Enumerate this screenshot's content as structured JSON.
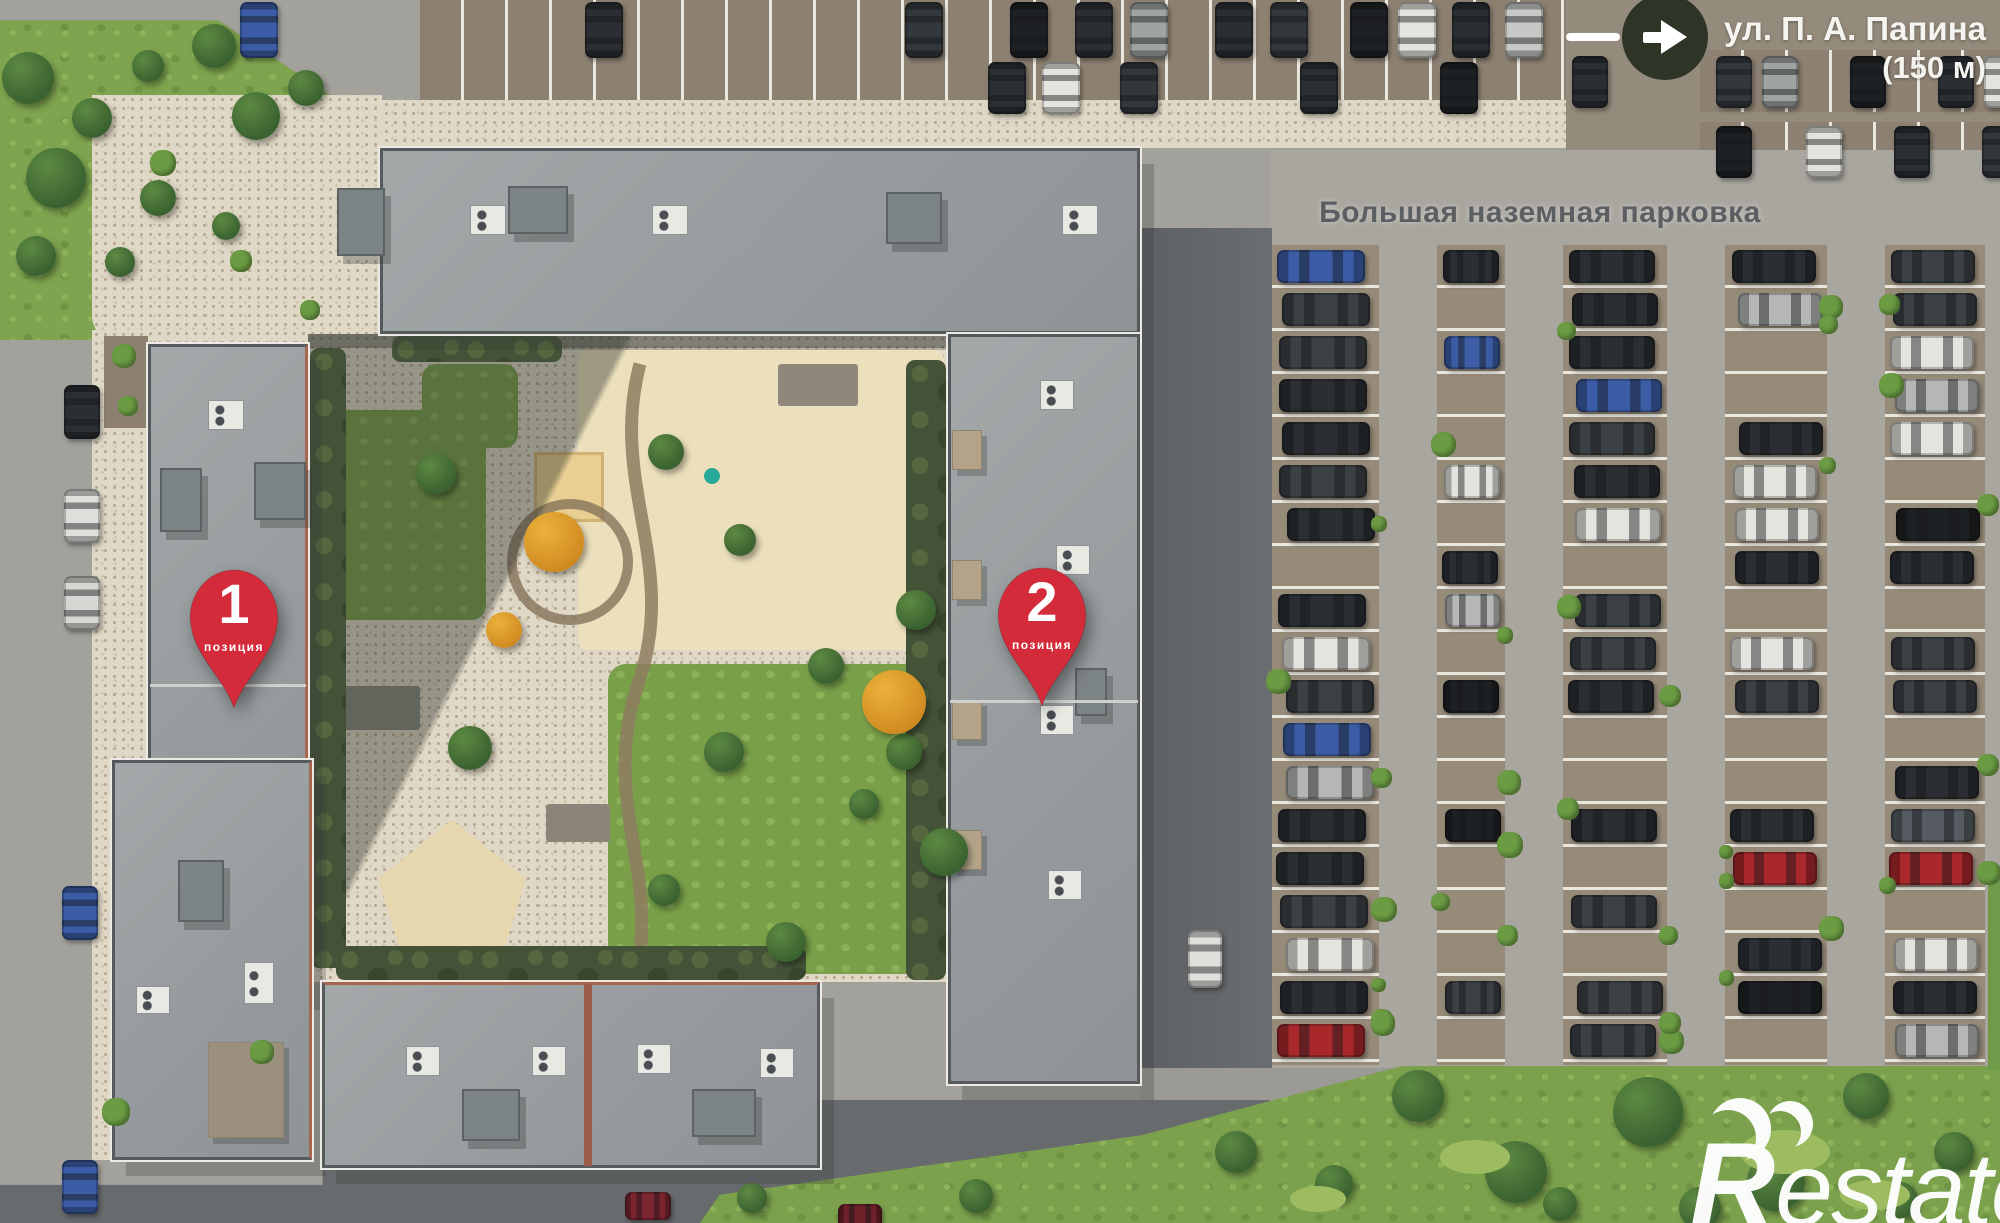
{
  "street_sign": {
    "name_line": "ул. П. А. Папина",
    "distance_line": "(150 м)"
  },
  "parking": {
    "label": "Большая наземная парковка"
  },
  "pins": [
    {
      "number": "1",
      "caption": "позиция"
    },
    {
      "number": "2",
      "caption": "позиция"
    }
  ],
  "watermark": {
    "brand": "Restate",
    "logo_letter": "R",
    "text_rest": "estate"
  },
  "colors": {
    "pin_red": "#d32b3a",
    "arrow_circle_bg": "#2e3426",
    "street_text": "#f5f4f0",
    "parking_label_text": "#5b5f62",
    "watermark": "#ffffff"
  }
}
